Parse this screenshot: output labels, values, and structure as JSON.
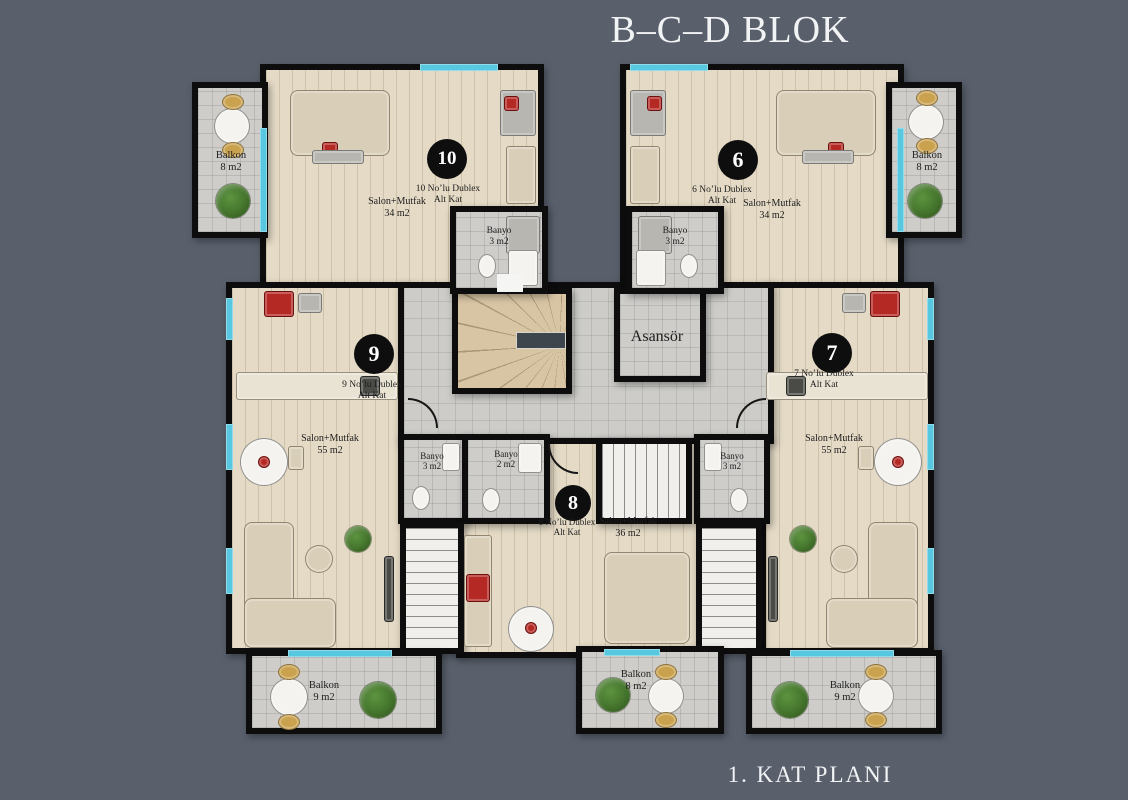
{
  "title": "B–C–D BLOK",
  "footer": "1. KAT PLANI",
  "core": {
    "elevator": "Asansör"
  },
  "units": [
    {
      "number": "10",
      "line1": "10 No’lu Dublex",
      "line2": "Alt Kat",
      "room": "Salon+Mutfak",
      "area": "34 m2"
    },
    {
      "number": "6",
      "line1": "6 No’lu Dublex",
      "line2": "Alt Kat",
      "room": "Salon+Mutfak",
      "area": "34 m2"
    },
    {
      "number": "9",
      "line1": "9 No’lu Dublex",
      "line2": "Alt Kat",
      "room": "Salon+Mutfak",
      "area": "55 m2"
    },
    {
      "number": "7",
      "line1": "7 No’lu Dublex",
      "line2": "Alt Kat",
      "room": "Salon+Mutfak",
      "area": "55 m2"
    },
    {
      "number": "8",
      "line1": "8 No’lu Dublex",
      "line2": "Alt Kat",
      "room": "Salon+Mutfak",
      "area": "36 m2"
    }
  ],
  "bathrooms": [
    {
      "label": "Banyo",
      "area": "3 m2"
    },
    {
      "label": "Banyo",
      "area": "3 m2"
    },
    {
      "label": "Banyo",
      "area": "3 m2"
    },
    {
      "label": "Banyo",
      "area": "2 m2"
    },
    {
      "label": "Banyo",
      "area": "3 m2"
    }
  ],
  "balconies": [
    {
      "label": "Balkon",
      "area": "8 m2"
    },
    {
      "label": "Balkon",
      "area": "8 m2"
    },
    {
      "label": "Balkon",
      "area": "9 m2"
    },
    {
      "label": "Balkon",
      "area": "8 m2"
    },
    {
      "label": "Balkon",
      "area": "9 m2"
    }
  ],
  "colors": {
    "background": "#59606c",
    "wall": "#0d0d0d",
    "wood_floor": "#e4dac6",
    "tile_floor": "#cecdca",
    "window": "#58c8e0",
    "badge": "#0e0e0e"
  }
}
